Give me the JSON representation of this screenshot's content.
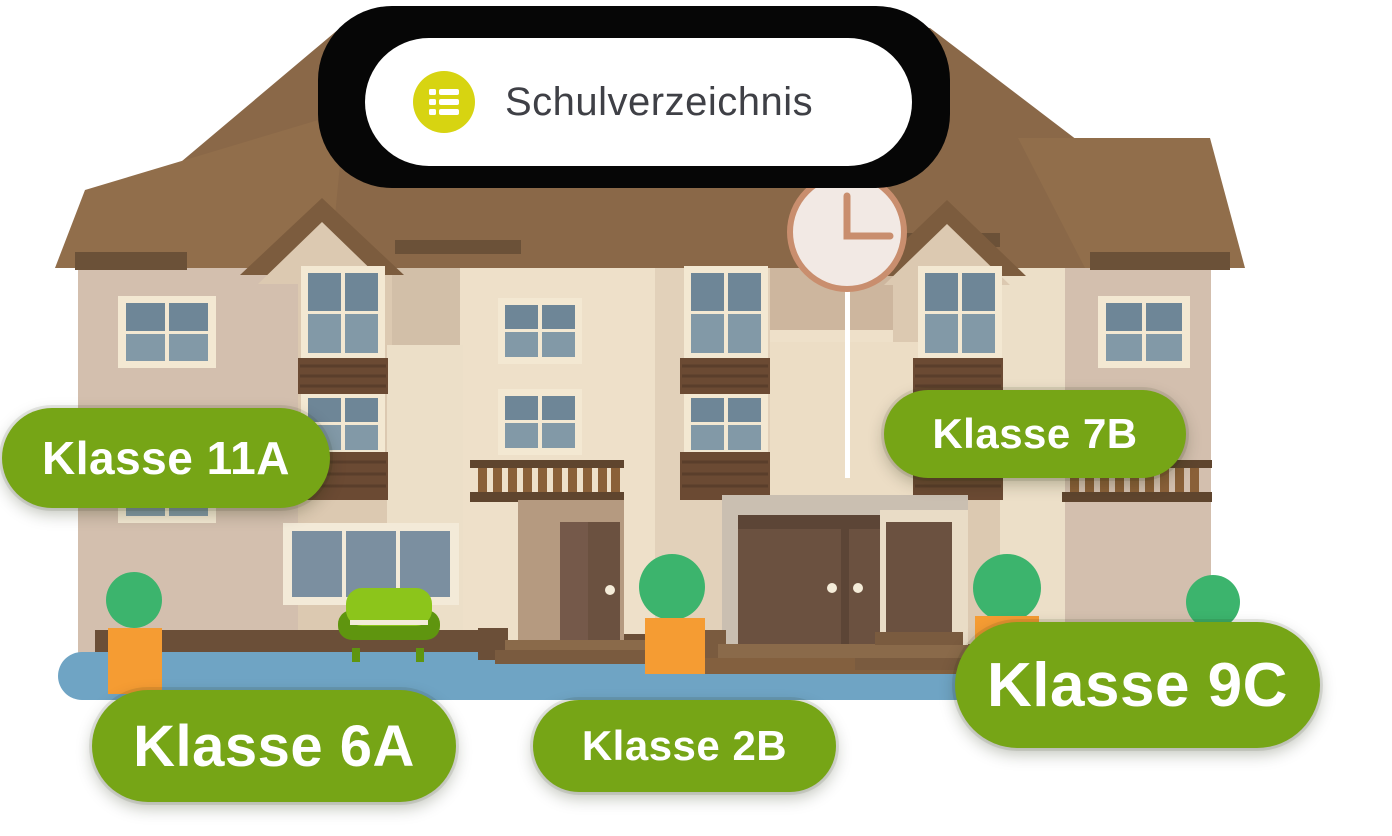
{
  "header": {
    "title": "Schulverzeichnis",
    "icon": "list-icon"
  },
  "classes": [
    {
      "label": "Klasse 11A"
    },
    {
      "label": "Klasse 7B"
    },
    {
      "label": "Klasse 6A"
    },
    {
      "label": "Klasse 2B"
    },
    {
      "label": "Klasse 9C"
    }
  ],
  "illustration": {
    "subject": "school building",
    "clock_time": "3:00",
    "tree_count": 4
  },
  "colors": {
    "pill_green": "#76a516",
    "pill_text": "#ffffff",
    "header_bg": "#ffffff",
    "header_text": "#3f4046",
    "header_icon_yellow": "#d7d411",
    "header_shadow_black": "#060606",
    "roof_brown": "#8a6848",
    "roof_light_brown": "#916e4b",
    "roof_trim_dark": "#6b5138",
    "wall_pink_tan": "#d3bfae",
    "wall_cream": "#eee0c9",
    "wall_cream_mid": "#dcc9b1",
    "window_frame_cream": "#f3e8d2",
    "window_slate": "#6e8697",
    "window_slate_light": "#8299a7",
    "spandrel_brown": "#6b4a33",
    "baluster_brown": "#8a6038",
    "door_brown": "#6b5140",
    "portico_gray_tan": "#cabfb1",
    "steps_brown": "#8a6a4a",
    "base_strip_brown": "#6b4f38",
    "ground_blue": "#6fa4c4",
    "tree_green": "#3cb46d",
    "planter_orange": "#f59c33",
    "sofa_green": "#8cc51b",
    "sofa_dark_green": "#5f950f",
    "clock_face": "#f2e9e4",
    "clock_trim": "#c98e6e"
  }
}
